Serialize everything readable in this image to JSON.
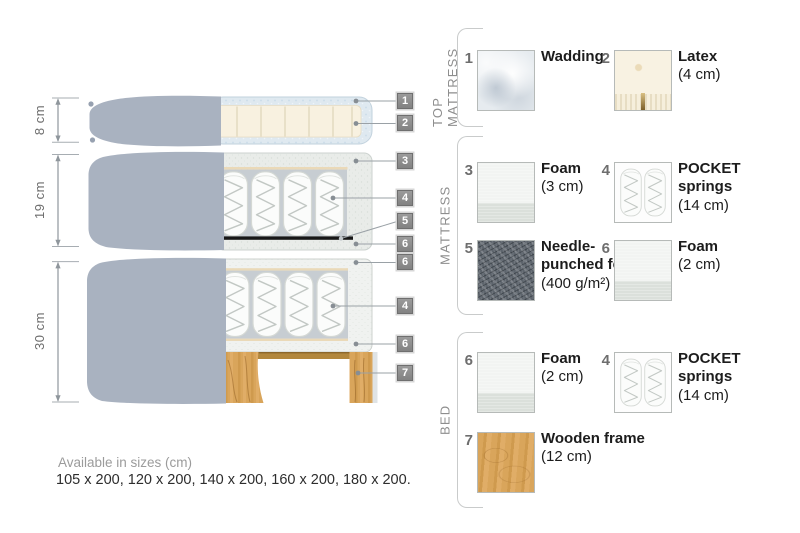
{
  "diagram": {
    "dimensions": [
      {
        "label": "8 cm"
      },
      {
        "label": "19 cm"
      },
      {
        "label": "30 cm"
      }
    ],
    "markers": [
      "1",
      "2",
      "3",
      "4",
      "5",
      "6",
      "6",
      "4",
      "6",
      "7"
    ],
    "colors": {
      "fabric_gray": "#a9b2c0",
      "wadding_blue": "#dfe9f0",
      "latex_cream": "#f8f1e0",
      "foam_speckle": "#e9ece9",
      "felt_dark": "#171717",
      "wood": "#d9a55b",
      "marker_gray": "#8c8c8c"
    }
  },
  "legend": {
    "sections": [
      {
        "title": "TOP MATTRESS",
        "items": [
          {
            "num": "1",
            "name": "Wadding",
            "size": "",
            "texture": "wadding"
          },
          {
            "num": "2",
            "name": "Latex",
            "size": "(4 cm)",
            "texture": "latex"
          }
        ]
      },
      {
        "title": "MATTRESS",
        "items": [
          {
            "num": "3",
            "name": "Foam",
            "size": "(3 cm)",
            "texture": "foam"
          },
          {
            "num": "4",
            "name": "POCKET springs",
            "size": "(14 cm)",
            "texture": "springs"
          },
          {
            "num": "5",
            "name": "Needle-punched felt",
            "size": "(400 g/m²)",
            "texture": "felt"
          },
          {
            "num": "6",
            "name": "Foam",
            "size": "(2 cm)",
            "texture": "foam"
          }
        ]
      },
      {
        "title": "BED",
        "items": [
          {
            "num": "6",
            "name": "Foam",
            "size": "(2 cm)",
            "texture": "foam"
          },
          {
            "num": "4",
            "name": "POCKET springs",
            "size": "(14 cm)",
            "texture": "springs"
          },
          {
            "num": "7",
            "name": "Wooden frame",
            "size": "(12 cm)",
            "texture": "wood"
          }
        ]
      }
    ]
  },
  "footer": {
    "line1": "Available in sizes (cm)",
    "line2": "105 x 200, 120 x 200, 140 x 200, 160 x 200, 180 x 200."
  }
}
